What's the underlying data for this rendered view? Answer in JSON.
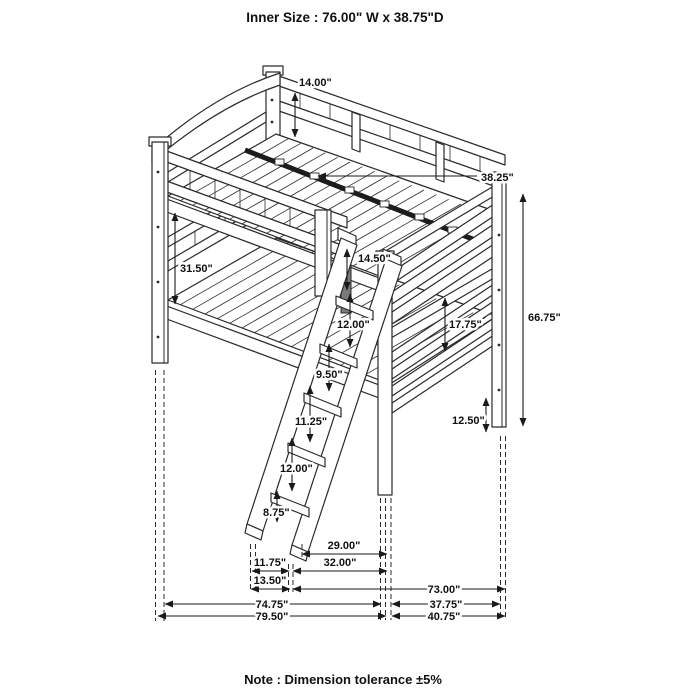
{
  "title": "Inner Size : 76.00\" W x  38.75\"D",
  "note": "Note : Dimension tolerance ±5%",
  "dimensions": {
    "headboard_height": "14.00\"",
    "slat_rail_length": "38.25\"",
    "bunk_gap_height": "31.50\"",
    "guard_rail_height": "14.50\"",
    "overall_height": "66.75\"",
    "footboard_height": "17.75\"",
    "ladder_step_1": "12.00\"",
    "ladder_step_2": "9.50\"",
    "ladder_step_3": "11.25\"",
    "ladder_step_4": "12.00\"",
    "ladder_step_5": "8.75\"",
    "leg_height": "12.50\"",
    "ladder_to_leg": "29.00\"",
    "ladder_to_leg_outer": "32.00\"",
    "ladder_depth": "11.75\"",
    "ladder_depth_outer": "13.50\"",
    "inner_length": "73.00\"",
    "length_to_leg": "74.75\"",
    "depth_inner": "37.75\"",
    "overall_length": "79.50\"",
    "overall_depth": "40.75\""
  }
}
